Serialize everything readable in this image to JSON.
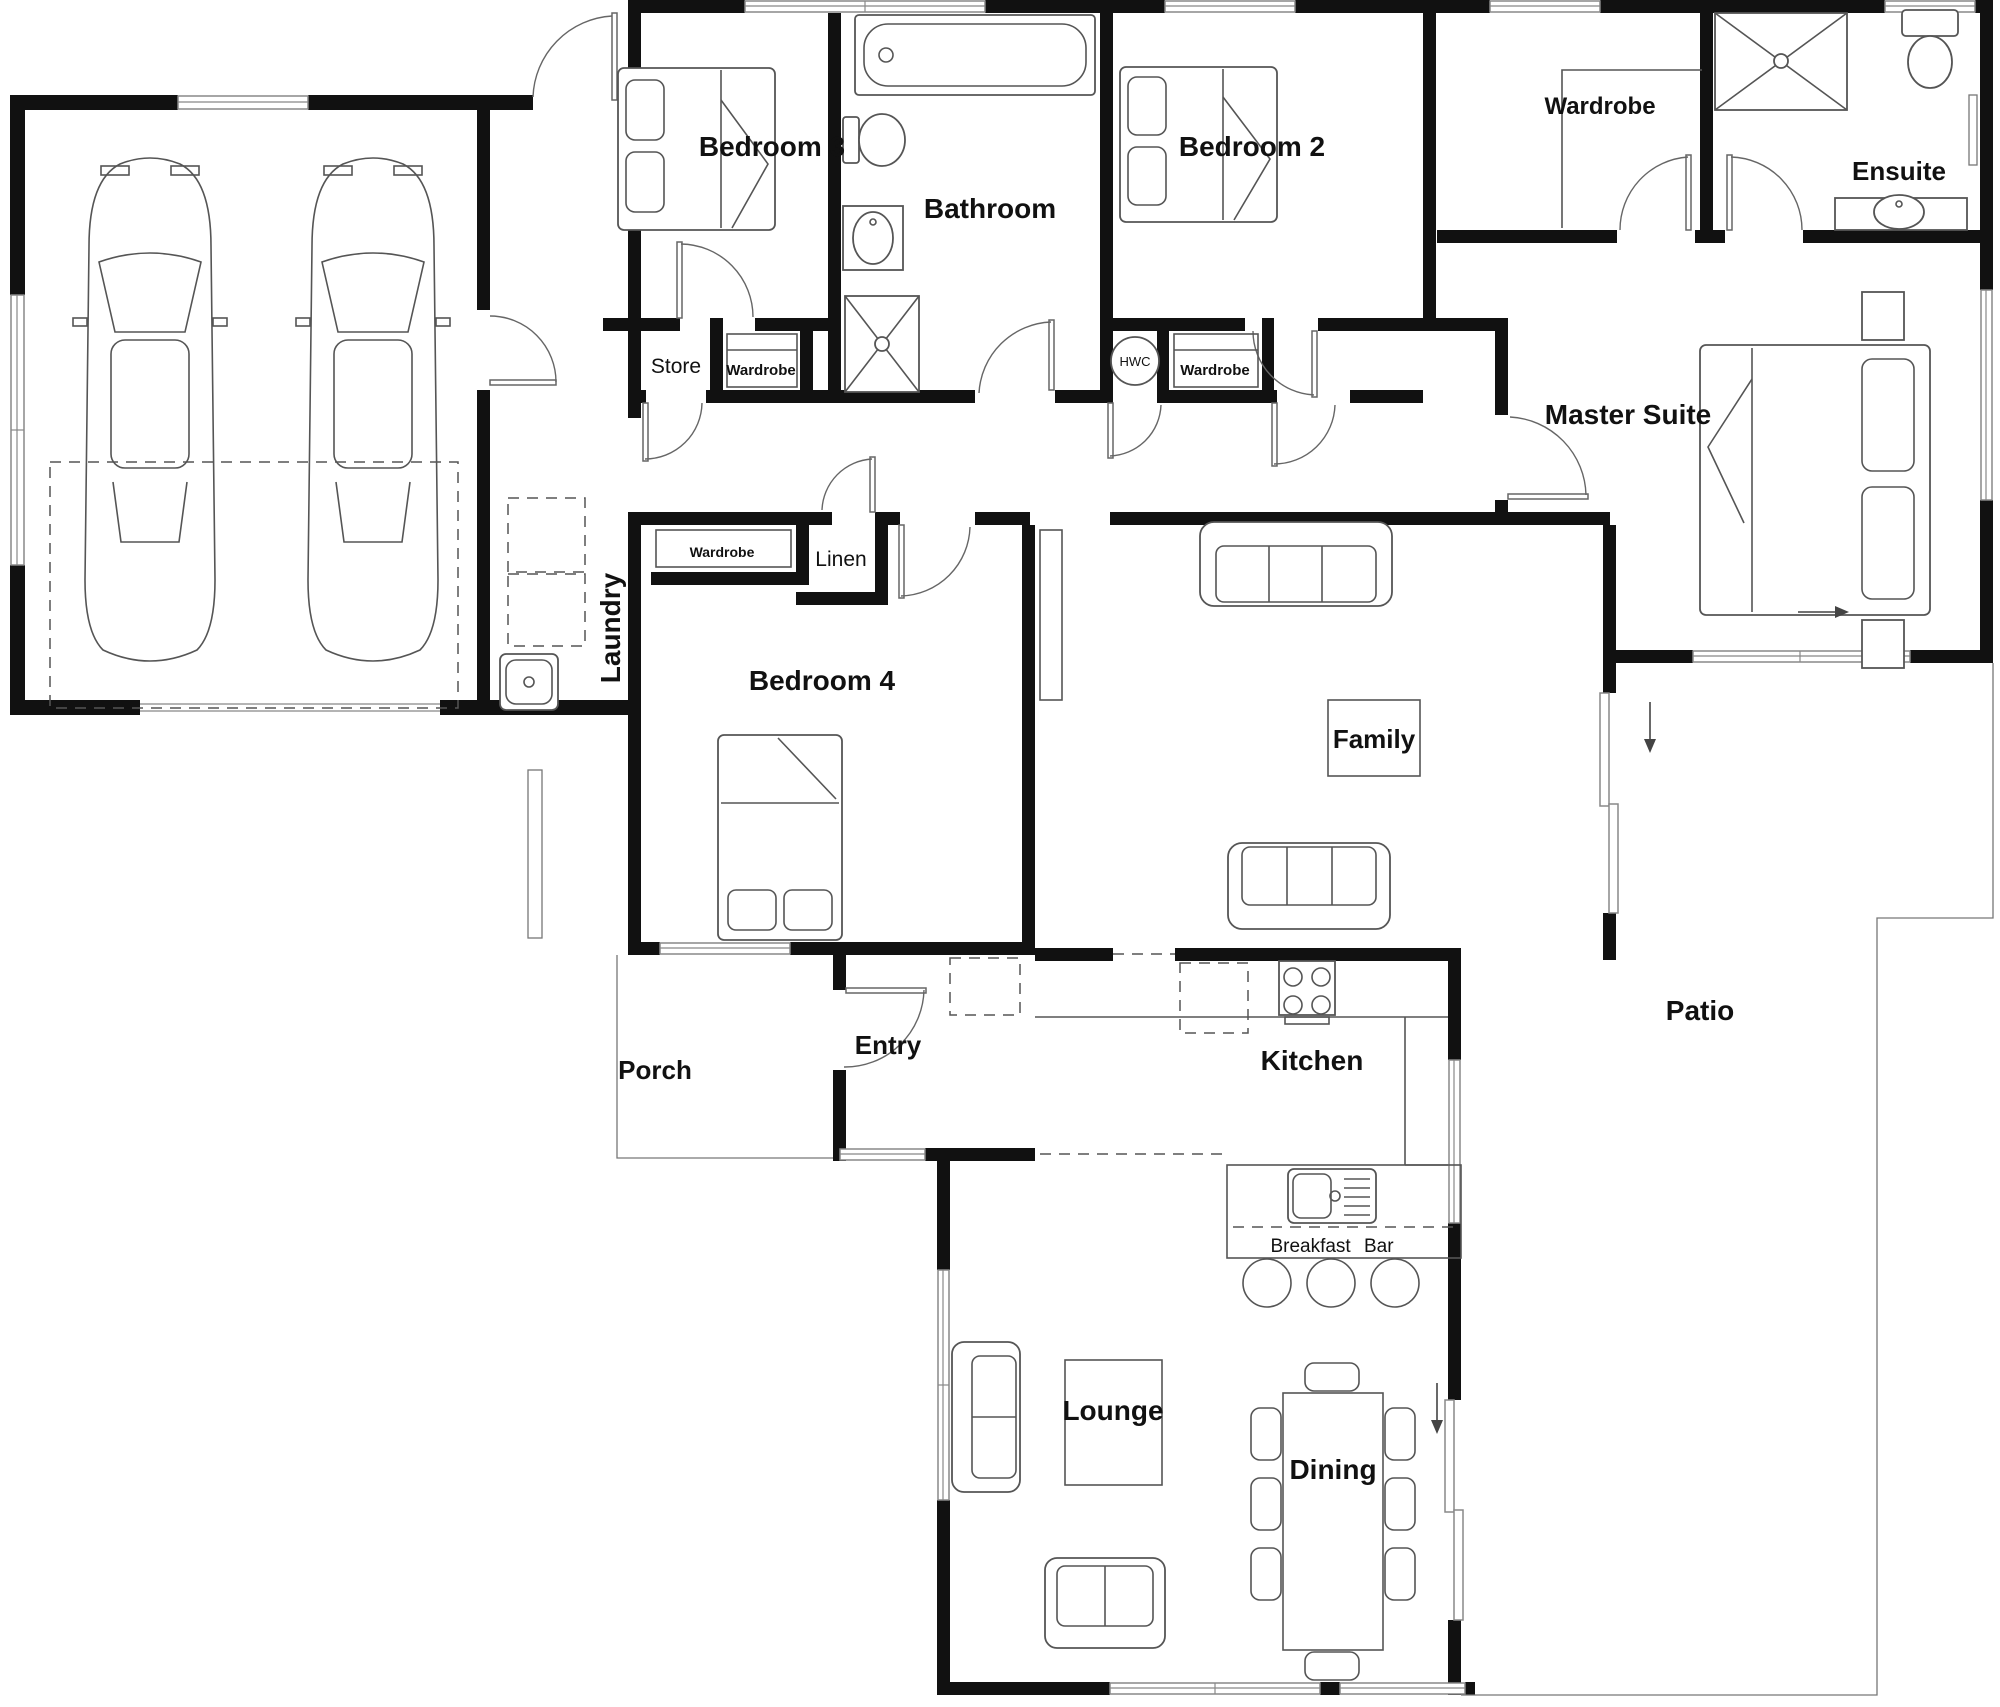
{
  "plan": {
    "labels": {
      "bedroom3": "Bedroom 3",
      "bathroom": "Bathroom",
      "bedroom2": "Bedroom 2",
      "master_wardrobe": "Wardrobe",
      "ensuite": "Ensuite",
      "master_suite": "Master Suite",
      "store": "Store",
      "bedroom3_wardrobe": "Wardrobe",
      "hwc": "HWC",
      "bedroom2_wardrobe": "Wardrobe",
      "laundry": "Laundry",
      "bedroom4_wardrobe": "Wardrobe",
      "linen": "Linen",
      "bedroom4": "Bedroom 4",
      "family": "Family",
      "porch": "Porch",
      "entry": "Entry",
      "kitchen": "Kitchen",
      "patio": "Patio",
      "lounge": "Lounge",
      "dining": "Dining",
      "breakfast_bar": "Breakfast Bar"
    },
    "colors": {
      "walls": "#111111",
      "furniture_outline": "#555555",
      "background": "#ffffff"
    }
  }
}
